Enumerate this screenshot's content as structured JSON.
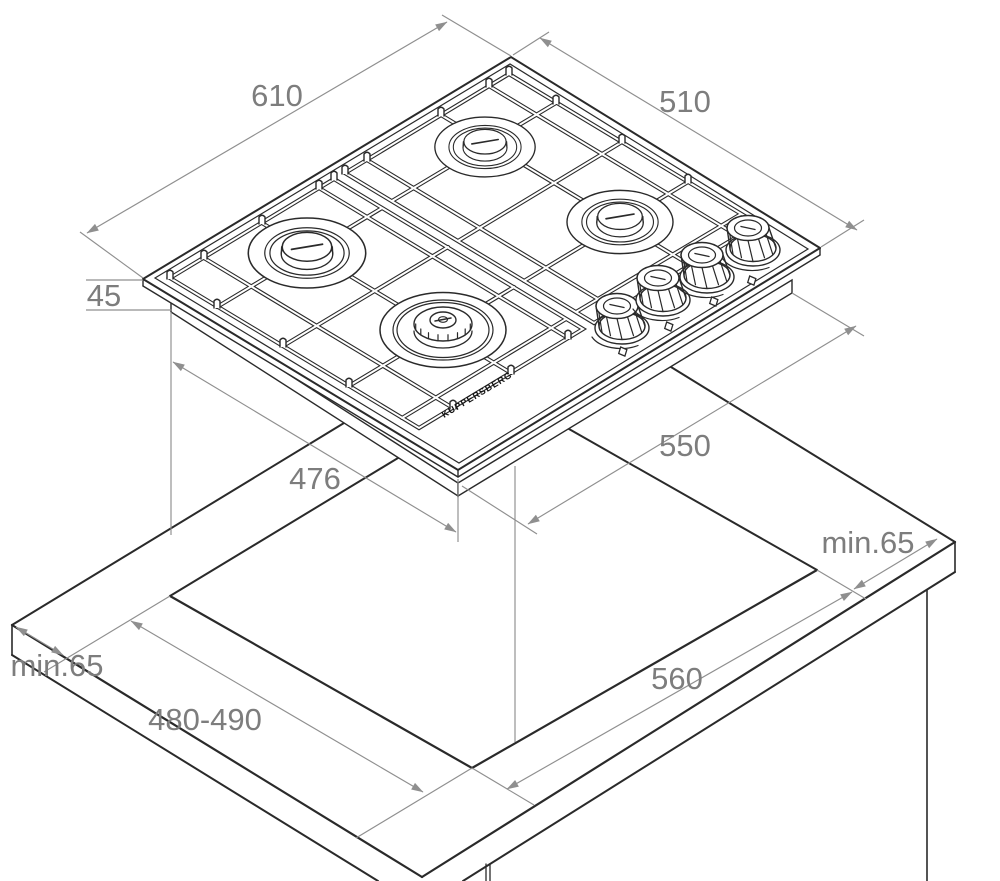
{
  "drawing": {
    "type": "gas-hob-installation-diagram",
    "brand": "KUPPERSBERG",
    "dimensions": {
      "hob_width": "610",
      "hob_depth": "510",
      "hob_height": "45",
      "base_depth": "476",
      "base_width": "550",
      "clearance_right": "min.65",
      "clearance_left": "min.65",
      "cutout_depth": "480-490",
      "cutout_width": "560"
    },
    "colors": {
      "outline": "#2a2a2a",
      "dimension_lines": "#8f8f8f",
      "dimension_text": "#7d7d7d",
      "background": "#ffffff"
    }
  }
}
